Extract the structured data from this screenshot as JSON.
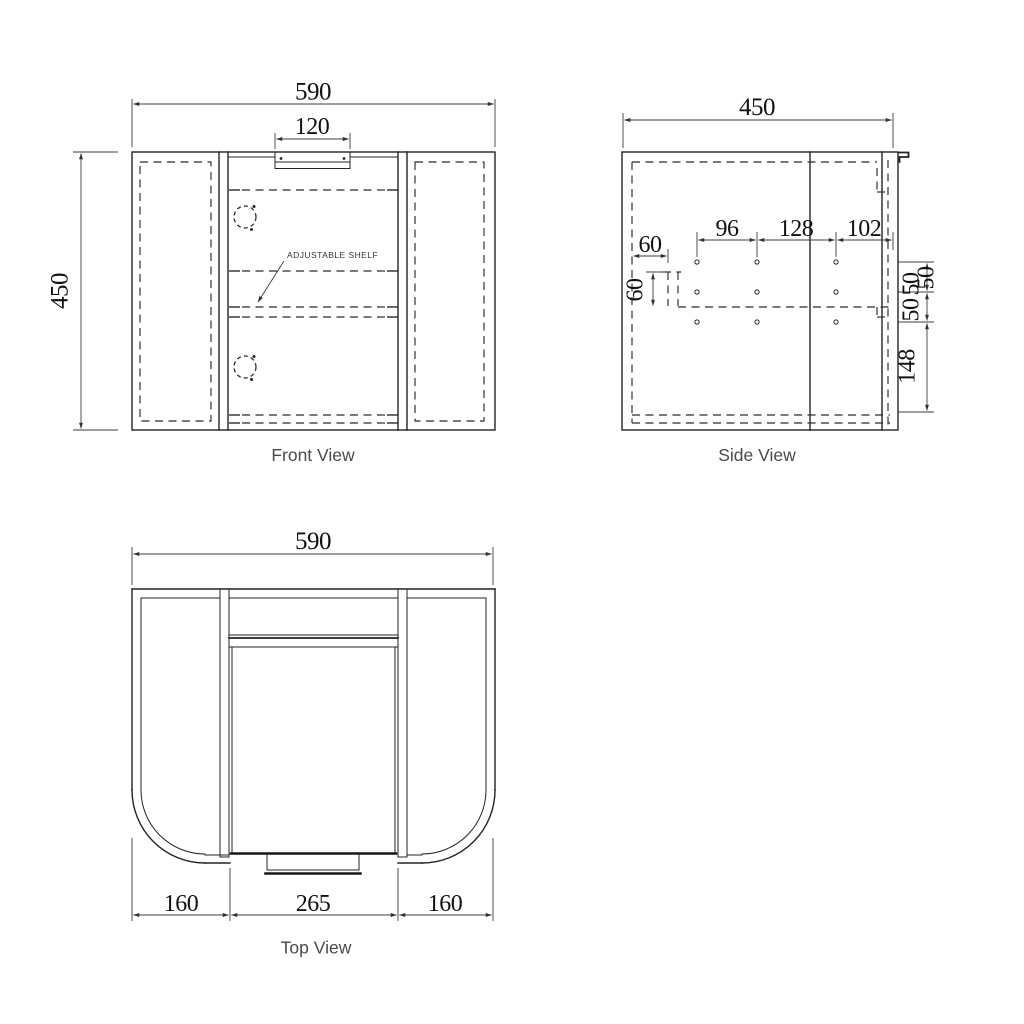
{
  "front_view": {
    "title": "Front View",
    "width": "590",
    "height": "450",
    "handle_recess_width": "120",
    "shelf_label": "ADJUSTABLE SHELF"
  },
  "side_view": {
    "title": "Side View",
    "depth": "450",
    "hole_spacing_a": "96",
    "hole_spacing_b": "128",
    "hole_spacing_c": "102",
    "offset_horizontal": "60",
    "offset_vertical": "60",
    "row_gap_a": "50",
    "row_gap_b": "50",
    "row_gap_c": "50",
    "bottom_gap": "148"
  },
  "top_view": {
    "title": "Top View",
    "width": "590",
    "left_section": "160",
    "center_section": "265",
    "right_section": "160"
  }
}
